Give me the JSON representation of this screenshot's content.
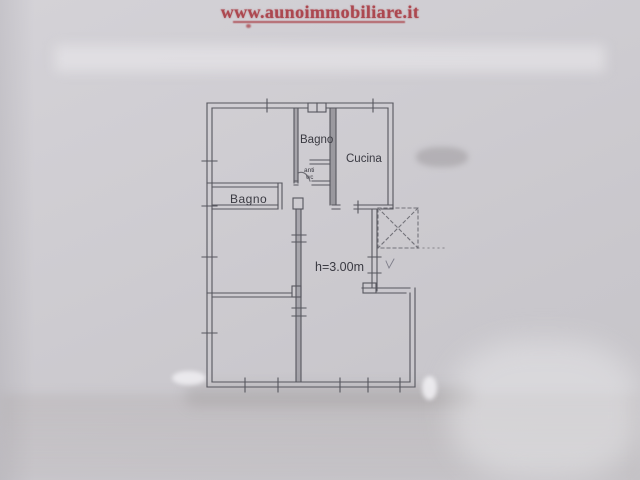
{
  "photo": {
    "watermark": {
      "text": "www.aunoimmobiliare.it",
      "color": "#ac4850"
    }
  },
  "floor_plan": {
    "line_color": "#56565e",
    "labels": {
      "bagno_top": "Bagno",
      "cucina": "Cucina",
      "anti": "anti",
      "wc": "wc",
      "bagno_left": "Bagno",
      "ceiling_height": "h=3.00m"
    }
  }
}
